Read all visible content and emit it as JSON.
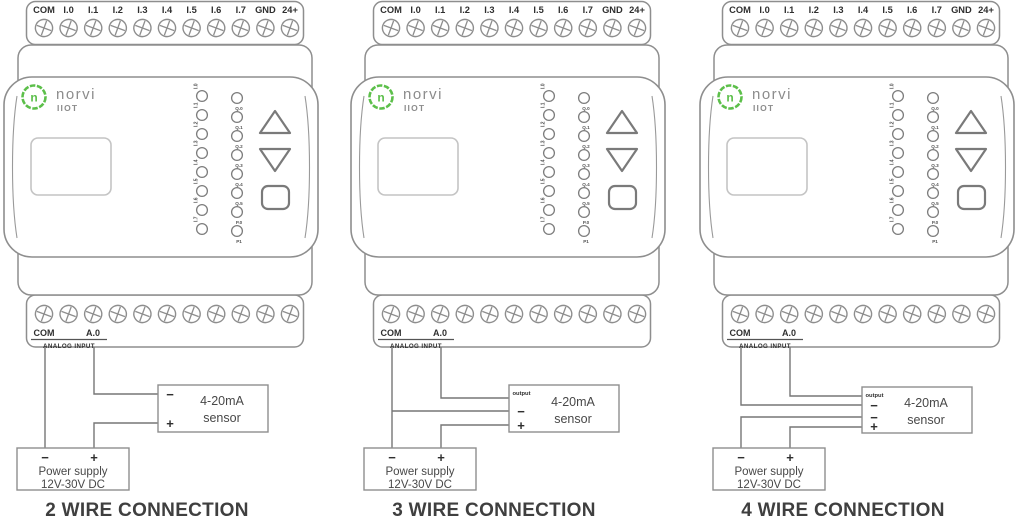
{
  "device": {
    "brand": {
      "logo_letter": "n",
      "name": "norvi",
      "model": "IIOT"
    },
    "top_terminals": [
      "COM",
      "I.0",
      "I.1",
      "I.2",
      "I.3",
      "I.4",
      "I.5",
      "I.6",
      "I.7",
      "GND",
      "24+"
    ],
    "input_leds": [
      "I.0",
      "I.1",
      "I.2",
      "I.3",
      "I.4",
      "I.5",
      "I.6",
      "I.7"
    ],
    "output_leds": [
      "Q.0",
      "Q.1",
      "Q.2",
      "Q.3",
      "Q.4",
      "Q.5",
      "P.0",
      "P1"
    ],
    "bottom_labels": {
      "com": "COM",
      "analog_out": "A.0",
      "group": "ANALOG INPUT"
    }
  },
  "sensor": {
    "line1": "4-20mA",
    "line2": "sensor"
  },
  "power_supply": {
    "line1": "Power supply",
    "line2": "12V-30V DC",
    "minus": "−",
    "plus": "+"
  },
  "diagrams": [
    {
      "id": "2-wire",
      "title": "2 WIRE CONNECTION",
      "sensor_terminals": [
        "−",
        "+"
      ]
    },
    {
      "id": "3-wire",
      "title": "3 WIRE CONNECTION",
      "sensor_terminals": [
        "output",
        "−",
        "+"
      ]
    },
    {
      "id": "4-wire",
      "title": "4 WIRE CONNECTION",
      "sensor_terminals": [
        "output",
        "−",
        "−",
        "+"
      ]
    }
  ],
  "colors": {
    "brand_green": "#5cbf4a",
    "outline": "#8e8e8e",
    "wire": "#767676",
    "text_dark": "#2f2f2f",
    "brand_gray": "#8c8c8c",
    "body_text": "#484848",
    "title": "#3f3f3f"
  }
}
